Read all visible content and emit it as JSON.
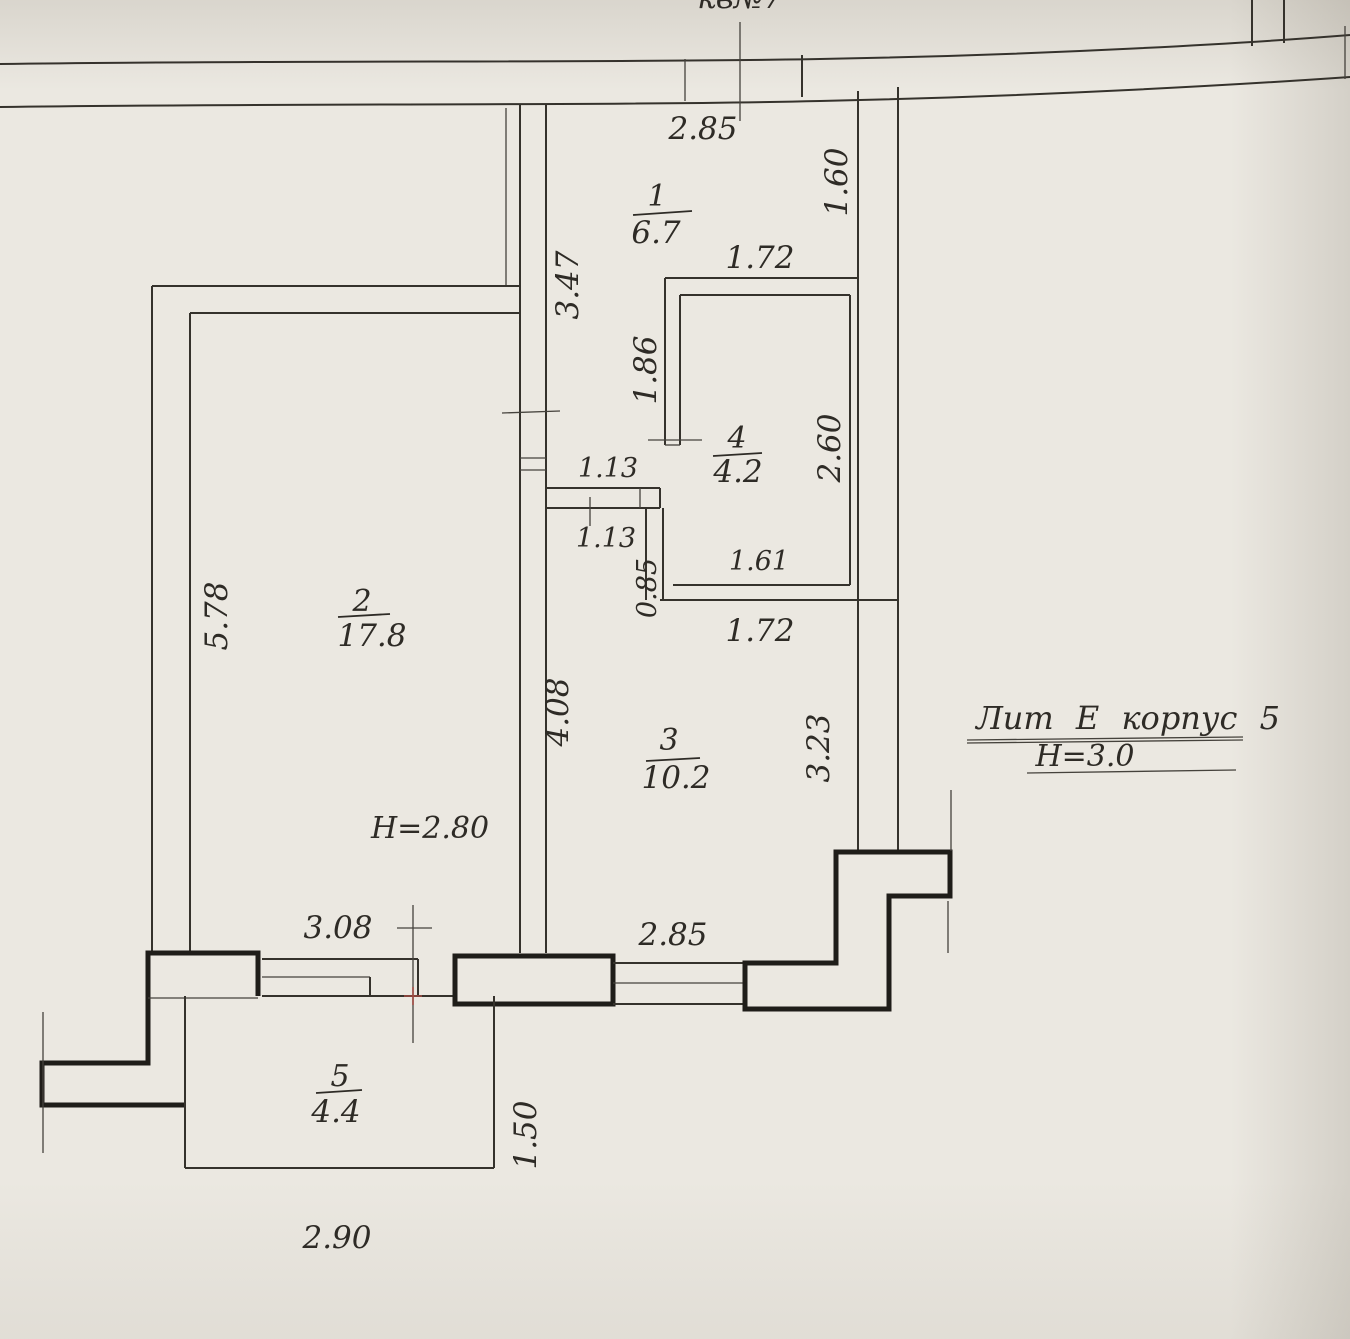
{
  "plan_header": {
    "apartment_note": "кв№7"
  },
  "title_block": {
    "line1": "Лит Е корпус 5",
    "line2": "Н=3.0"
  },
  "rooms": {
    "r1": {
      "number": "1",
      "area": "6.7"
    },
    "r2": {
      "number": "2",
      "area": "17.8",
      "height_note": "Н=2.80"
    },
    "r3": {
      "number": "3",
      "area": "10.2"
    },
    "r4": {
      "number": "4",
      "area": "4.2"
    },
    "r5": {
      "number": "5",
      "area": "4.4"
    }
  },
  "dims": {
    "top_width": "2.85",
    "hall_right": "1.60",
    "room4_top": "1.72",
    "hall_left_upper": "3.47",
    "room4_left": "1.86",
    "room4_right": "2.60",
    "door_width_a": "1.13",
    "door_width_b": "1.13",
    "nook_wall": "0.85",
    "room4_bottom_inner": "1.61",
    "room4_bottom_outer": "1.72",
    "room2_left": "5.78",
    "room3_left": "4.08",
    "room3_right": "3.23",
    "room2_bottom": "3.08",
    "room3_bottom": "2.85",
    "balcony_right": "1.50",
    "balcony_bottom": "2.90"
  }
}
